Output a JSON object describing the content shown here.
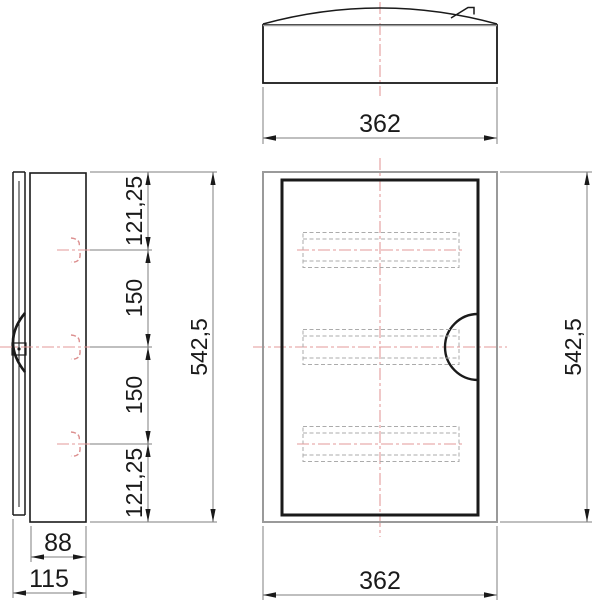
{
  "drawing": {
    "type": "technical-three-view-drawing",
    "subject": "wall-mounted electrical enclosure with curved lid",
    "labels": {
      "top_width": "362",
      "front_width": "362",
      "front_height": "542,5",
      "side_height": "542,5",
      "side_segments": [
        "121,25",
        "150",
        "150",
        "121,25"
      ],
      "depth_inner": "88",
      "depth_total": "115"
    },
    "colors": {
      "ink": "#1a1a1a",
      "frame": "#9a9a9a",
      "dim": "#7f7f7f",
      "dashgray": "#ababab",
      "red": "#e39a9a",
      "redmark": "#dc8f8f"
    }
  }
}
